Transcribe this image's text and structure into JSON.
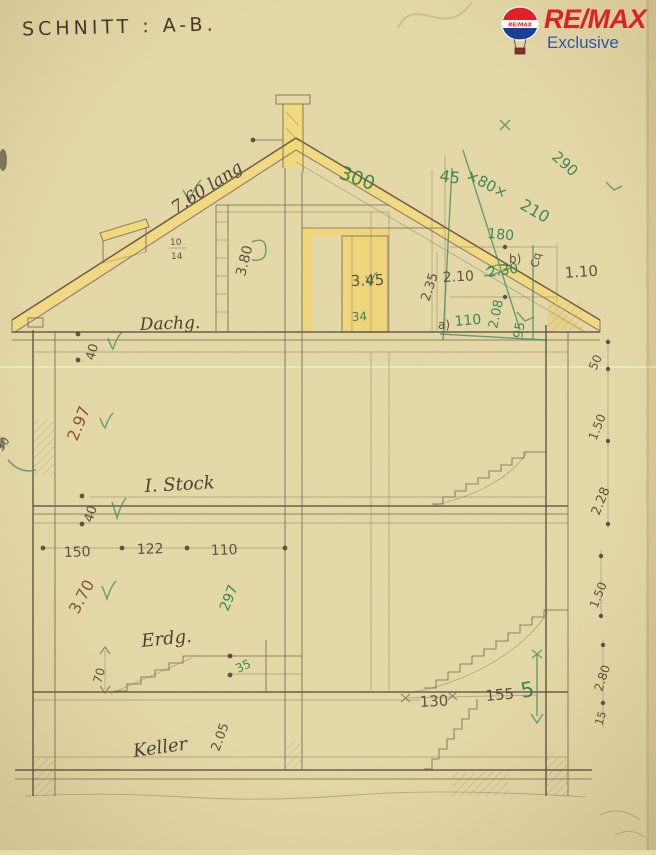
{
  "header": {
    "title": "SCHNITT : A-B."
  },
  "logo": {
    "brand": "RE/MAX",
    "subtitle": "Exclusive",
    "balloon_text": "RE/MAX",
    "colors": {
      "red": "#e01f26",
      "blue": "#2a58a7",
      "balloon_blue": "#1b3f94"
    }
  },
  "floors": {
    "attic_label": "Dachg.",
    "first_label": "I. Stock",
    "ground_label": "Erdg.",
    "basement_label": "Keller"
  },
  "palette": {
    "paper": "#e7daa9",
    "pencil": "#544837",
    "green_pen": "#2f7e4e",
    "red_pencil": "#8a4a38",
    "roof_highlight": "#f2d978"
  },
  "ann": {
    "roof_left_len": "7.60 lang",
    "roof_right_len": "300",
    "d45": "45",
    "d80": "×80×",
    "d210": "210",
    "d290": "290",
    "d180": "180",
    "d110a": "1.10",
    "d210b": "2.10",
    "d230": "2.30",
    "mark_b": "b)",
    "mark_cq": "Cq",
    "d208": "2.08",
    "d95": "95",
    "d110b": "110",
    "mark_a": "a)",
    "d235": "2.35",
    "d345": "3.45",
    "d34": "34",
    "d380": "3.80",
    "dormer_num": "10",
    "dormer_den": "14",
    "d40a": "40",
    "d297": "2.97",
    "d40b": "40",
    "d50": "50",
    "d150a": "1.50",
    "d228": "2.28",
    "w150": "150",
    "w122": "122",
    "w110": "110",
    "d370": "3.70",
    "d297g": "297",
    "d70": "70",
    "d35": "35",
    "d205": "2.05",
    "w130": "130",
    "w155": "155",
    "g5": "5",
    "d150b": "1.50",
    "d280": "2.80",
    "d15": "15",
    "d30": "30"
  }
}
